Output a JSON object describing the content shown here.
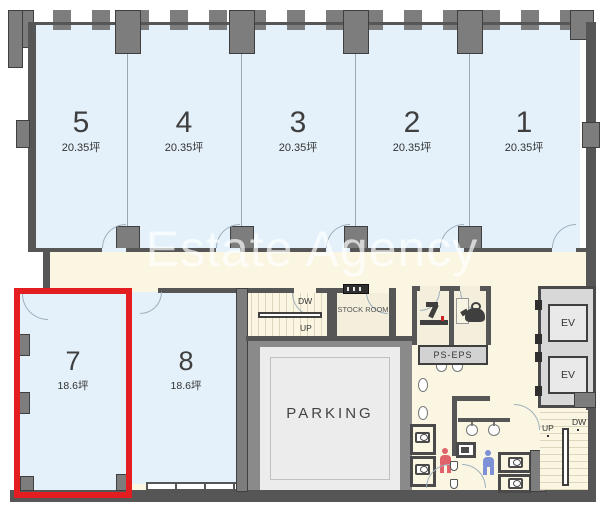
{
  "watermark_text": "Estate Agency",
  "top_units": [
    {
      "number": "5",
      "area": "20.35坪"
    },
    {
      "number": "4",
      "area": "20.35坪"
    },
    {
      "number": "3",
      "area": "20.35坪"
    },
    {
      "number": "2",
      "area": "20.35坪"
    },
    {
      "number": "1",
      "area": "20.35坪"
    }
  ],
  "bottom_units": [
    {
      "number": "7",
      "area": "18.6坪",
      "highlighted": true
    },
    {
      "number": "8",
      "area": "18.6坪",
      "highlighted": false
    }
  ],
  "labels": {
    "parking": "PARKING",
    "stock_room": "STOCK ROOM",
    "ps_eps": "PS-EPS",
    "elevator": "EV",
    "stair_center_up": "UP",
    "stair_center_down": "DW",
    "stair_right_up": "UP",
    "stair_right_down": "DW"
  },
  "highlight": {
    "unit": "7",
    "color": "#e41e20"
  },
  "colors": {
    "unit_fill": "#e4f1fa",
    "corridor_fill": "#faf6e2",
    "wall": "#565656",
    "parking_surround": "#8a8a8a",
    "woman_icon": "#e0636b",
    "man_icon": "#7e90d6"
  }
}
